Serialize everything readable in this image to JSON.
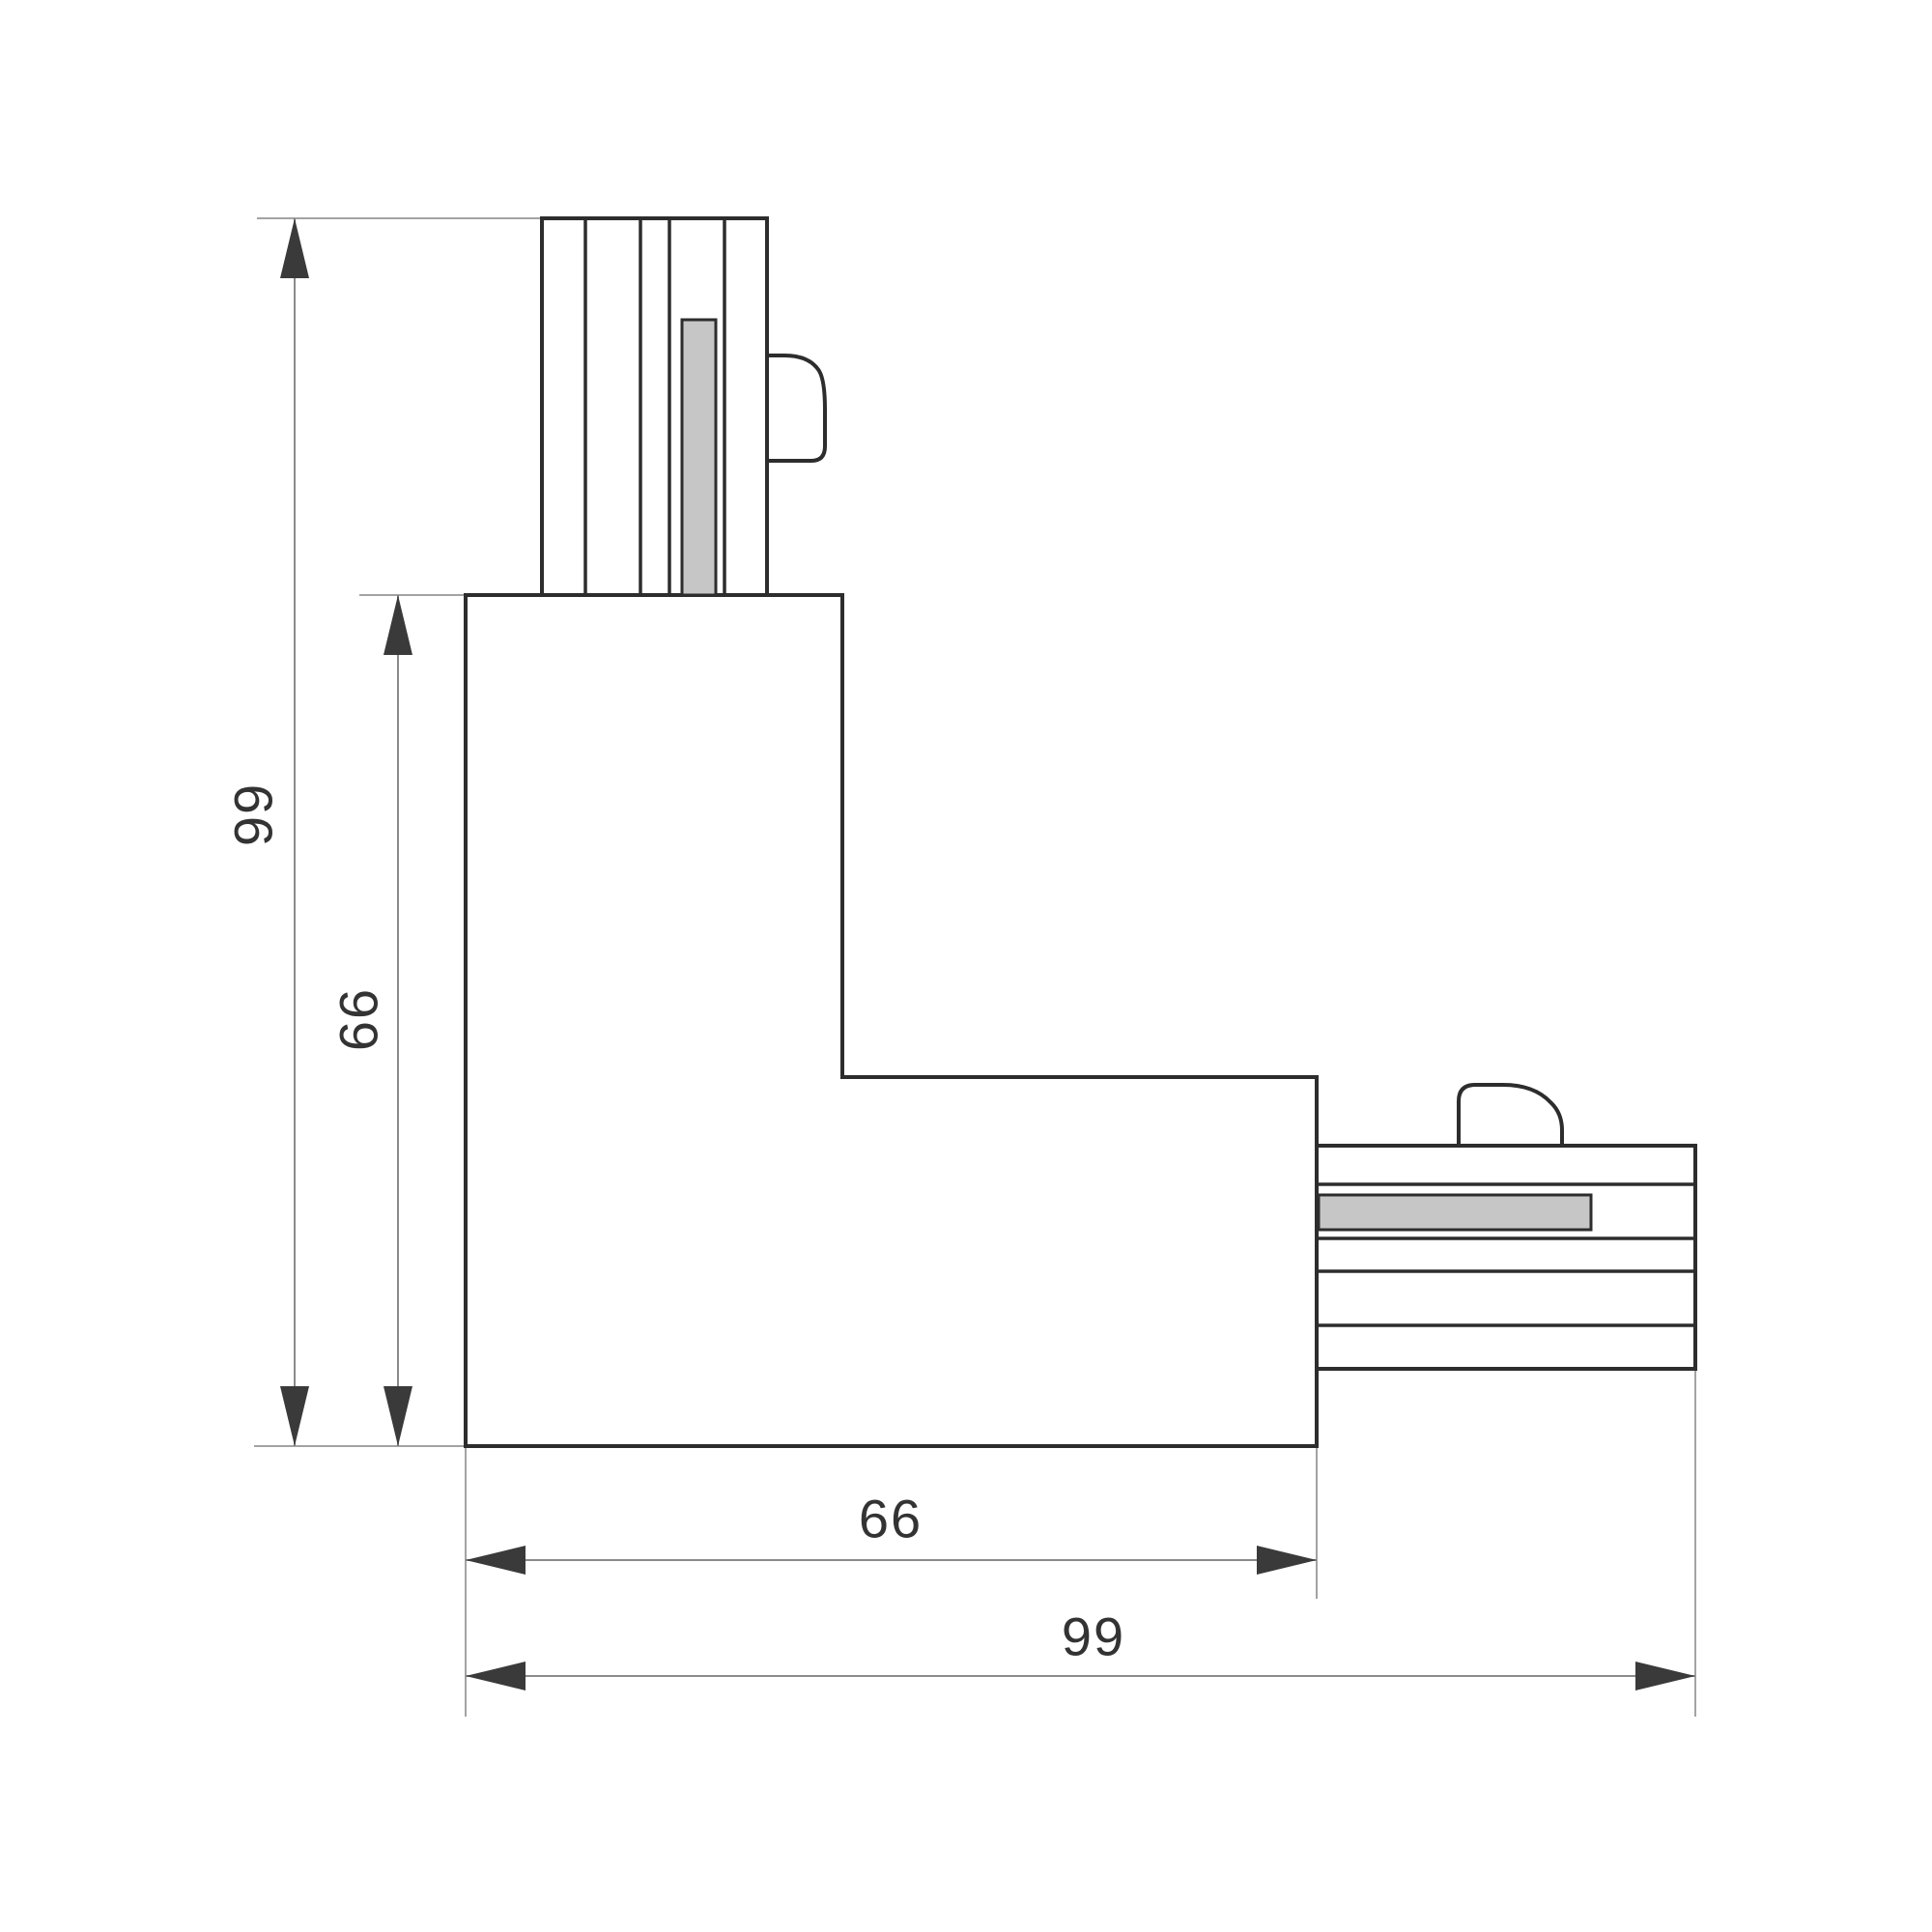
{
  "dimensions": {
    "overall_height": {
      "label": "99"
    },
    "body_height": {
      "label": "66"
    },
    "body_width": {
      "label": "66"
    },
    "overall_width": {
      "label": "99"
    }
  },
  "colors": {
    "background": "#ffffff",
    "outline": "#2d2d2d",
    "part_fill": "#ffffff",
    "contact_bar_fill": "#c5c6c5",
    "dimension_line": "#8a8a8a",
    "extension_line": "#a3a3a3",
    "arrow": "#3a3a3a",
    "label_text": "#333333"
  }
}
